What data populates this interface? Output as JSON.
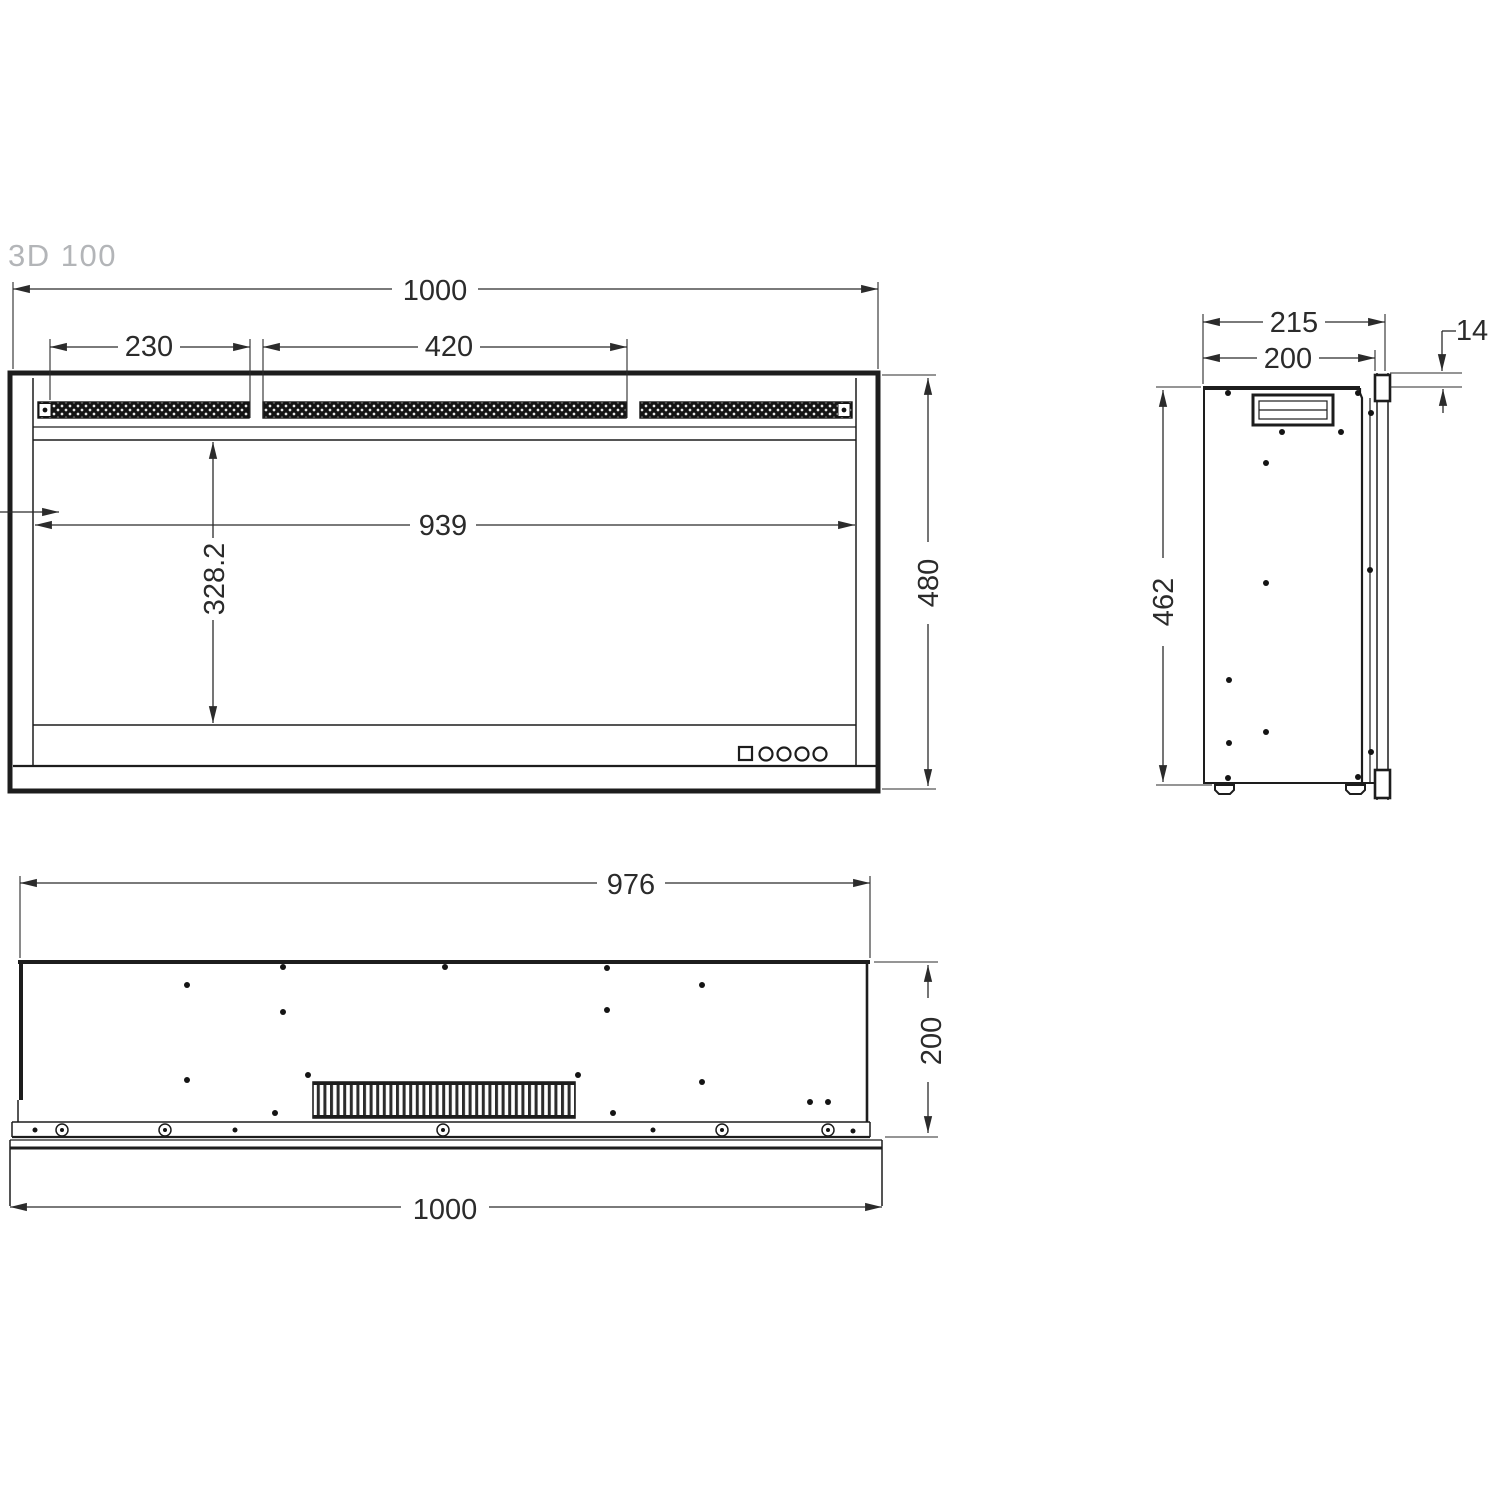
{
  "title": "3D 100",
  "front_view": {
    "dims": {
      "overall_width": "1000",
      "left_grille_width": "230",
      "center_grille_width": "420",
      "opening_width": "939",
      "opening_height": "328.2",
      "overall_height": "480"
    }
  },
  "side_view": {
    "dims": {
      "overall_depth": "215",
      "body_depth": "200",
      "flange_thickness": "14",
      "body_height": "462"
    }
  },
  "bottom_view": {
    "dims": {
      "body_width": "976",
      "body_depth": "200",
      "overall_width": "1000"
    }
  },
  "colors": {
    "line": "#1d1d1d",
    "dim_text": "#2b2b2b",
    "title_gray": "#b3b5b8",
    "grille_dark": "#141414"
  }
}
